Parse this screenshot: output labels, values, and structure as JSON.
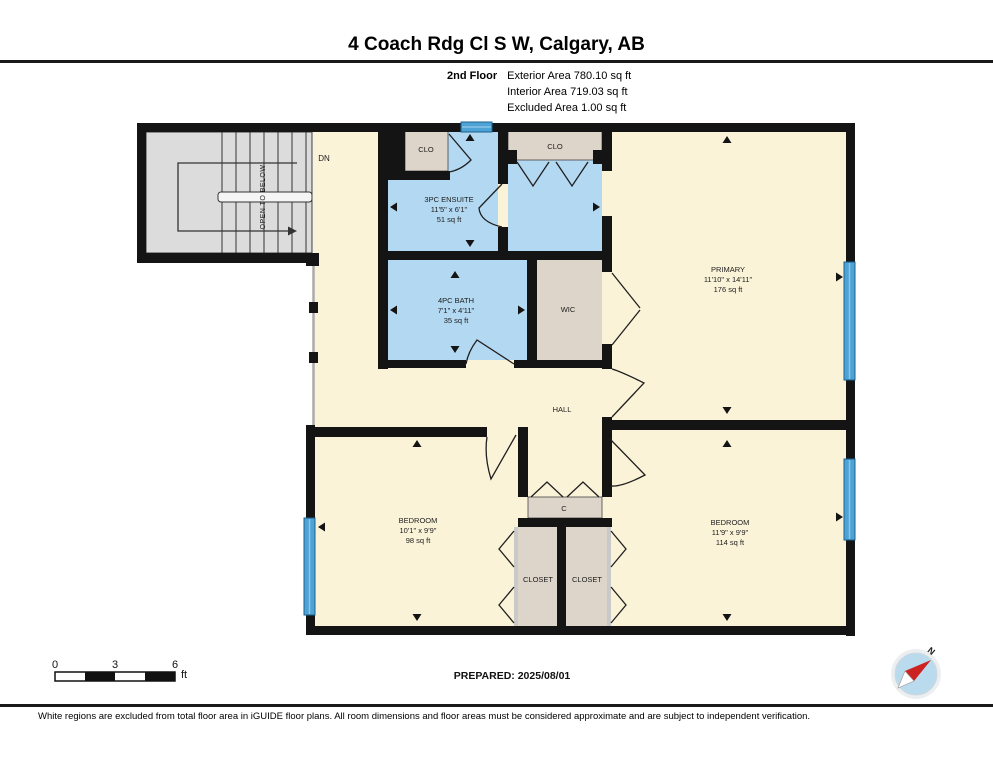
{
  "header": {
    "title": "4 Coach Rdg Cl S W, Calgary, AB",
    "floor_label": "2nd Floor",
    "area_lines": [
      "Exterior Area 780.10 sq ft",
      "Interior Area 719.03 sq ft",
      "Excluded Area 1.00 sq ft"
    ]
  },
  "plan": {
    "rooms": {
      "ensuite": {
        "name": "3PC ENSUITE",
        "dims": "11'5\" x 6'1\"",
        "area": "51 sq ft"
      },
      "bath": {
        "name": "4PC BATH",
        "dims": "7'1\" x 4'11\"",
        "area": "35 sq ft"
      },
      "primary": {
        "name": "PRIMARY",
        "dims": "11'10\" x 14'11\"",
        "area": "176 sq ft"
      },
      "bedroom_left": {
        "name": "BEDROOM",
        "dims": "10'1\" x 9'9\"",
        "area": "98 sq ft"
      },
      "bedroom_right": {
        "name": "BEDROOM",
        "dims": "11'9\" x 9'9\"",
        "area": "114 sq ft"
      }
    },
    "labels": {
      "wic": "WIC",
      "hall": "HALL",
      "clo_ensuite": "CLO",
      "clo_vestibule": "CLO",
      "c_closet": "C",
      "closet_left": "CLOSET",
      "closet_right": "CLOSET",
      "dn": "DN",
      "open_to_below": "OPEN TO BELOW"
    }
  },
  "scale_bar": {
    "tick_0": "0",
    "tick_3": "3",
    "tick_6": "6",
    "unit": "ft"
  },
  "prepared_label": "PREPARED: 2025/08/01",
  "compass": {
    "north_label": "N"
  },
  "footer_note": "White regions are excluded from total floor area in iGUIDE floor plans. All room dimensions and floor areas must be considered approximate and are subject to independent verification.",
  "colors": {
    "floor_cream": "#fbf3d8",
    "room_blue": "#b3d8f1",
    "closet_beige": "#ddd5c9",
    "stair_gray": "#dcdcdc",
    "window_blue": "#4ea3d6",
    "wall_black": "#141414"
  }
}
